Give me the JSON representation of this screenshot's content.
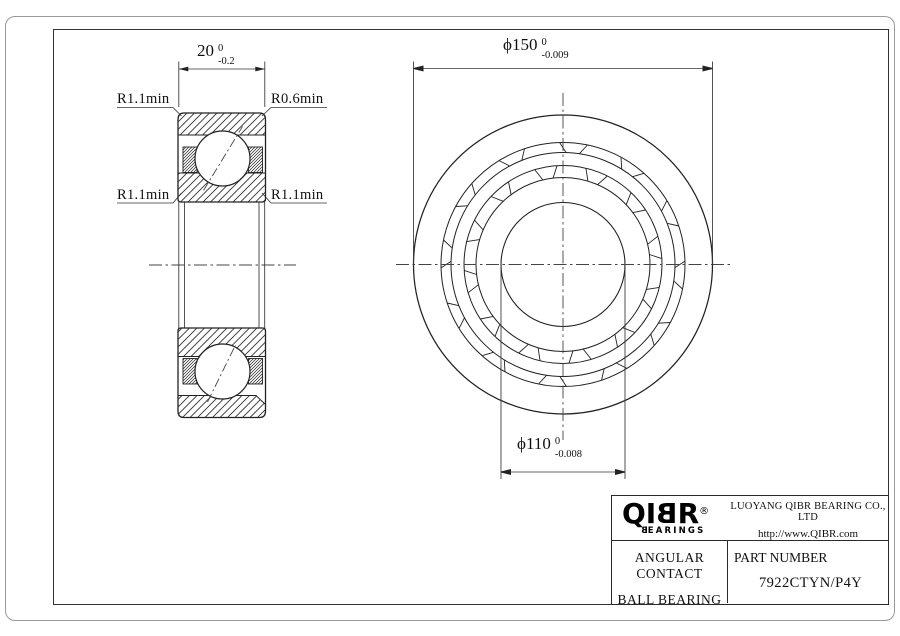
{
  "dimensions": {
    "width": {
      "text": "20",
      "tol_upper": "0",
      "tol_lower": "-0.2"
    },
    "outer_diameter": {
      "text": "ϕ150",
      "tol_upper": "0",
      "tol_lower": "-0.009"
    },
    "bore_diameter": {
      "text": "ϕ110",
      "tol_upper": "0",
      "tol_lower": "-0.008"
    }
  },
  "radius_labels": {
    "top_left": "R1.1min",
    "top_right": "R0.6min",
    "mid_left": "R1.1min",
    "mid_right": "R1.1min"
  },
  "title_block": {
    "logo": {
      "part1": "QI",
      "part2": "B",
      "part3": "R",
      "registered": "®",
      "tagline_b": "B",
      "tagline_rest": "EARINGS"
    },
    "company_name": "LUOYANG QIBR BEARING CO., LTD",
    "website": "http://www.QIBR.com",
    "product_line1": "ANGULAR CONTACT",
    "product_line2": "BALL BEARING",
    "part_number_label": "PART NUMBER",
    "part_number_value": "7922CTYN/P4Y"
  }
}
